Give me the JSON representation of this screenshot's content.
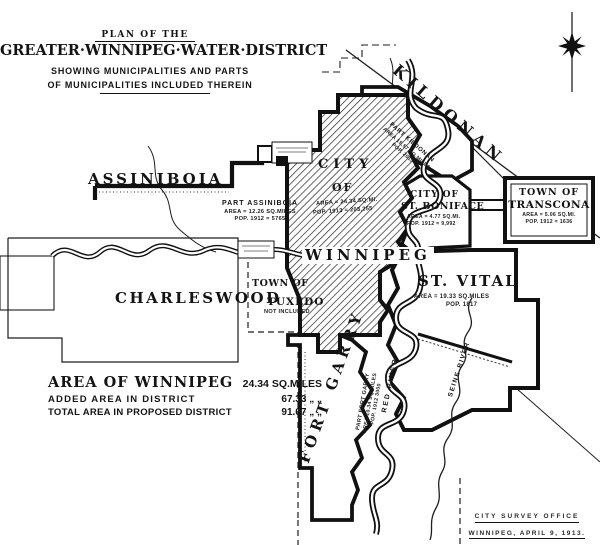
{
  "colors": {
    "ink": "#161616",
    "paper": "#ffffff"
  },
  "title": {
    "kicker": "PLAN OF THE",
    "main": "GREATER·WINNIPEG·WATER·DISTRICT",
    "sub1": "SHOWING MUNICIPALITIES AND PARTS",
    "sub2": "OF MUNICIPALITIES INCLUDED THEREIN"
  },
  "regions": {
    "assiniboia": {
      "name": "ASSINIBOIA",
      "part": "PART ASSINIBOIA",
      "area": "AREA = 12.26 SQ.MILES",
      "pop": "POP. 1912 = 5765"
    },
    "charleswood": {
      "name": "CHARLESWOOD"
    },
    "kildonan": {
      "name": "KILDONAN",
      "part": "PART KILDONAN",
      "area": "AREA 15.57 SQ.MILES",
      "pop": "POP. 2015"
    },
    "winnipeg": {
      "line1": "CITY",
      "line2": "OF",
      "line3": "WINNIPEG",
      "area": "AREA = 24.34 SQ.MI.",
      "pop": "POP. 1913 = 203,255"
    },
    "st_boniface": {
      "line1": "CITY OF",
      "line2": "ST. BONIFACE",
      "area": "AREA = 4.77 SQ.MI.",
      "pop": "POP. 1912 = 9,992"
    },
    "transcona": {
      "line1": "TOWN OF",
      "line2": "TRANSCONA",
      "area": "AREA = 5.06 SQ.MI.",
      "pop": "POP. 1912 = 1636"
    },
    "st_vital": {
      "name": "ST. VITAL",
      "area": "AREA = 19.33 SQ.MILES",
      "pop": "POP. 1817"
    },
    "tuxedo": {
      "line1": "TOWN OF",
      "line2": "TUXEDO",
      "note": "NOT INCLUDED"
    },
    "fort_garry": {
      "name": "FORT GARRY",
      "part": "PART FORT GARRY",
      "area": "AREA 10.34 SQ.MILES",
      "pop": "POP. 1912 3000"
    }
  },
  "rivers": {
    "red": "RED RIVER",
    "seine": "SEINE RIVER"
  },
  "legend": {
    "rows": [
      {
        "label": "AREA OF WINNIPEG",
        "value": "24.34 SQ.MILES"
      },
      {
        "label": "ADDED AREA IN DISTRICT",
        "value": "67.33 „   „"
      },
      {
        "label": "TOTAL AREA IN PROPOSED DISTRICT",
        "value": "91.67 „   „"
      }
    ]
  },
  "credit": {
    "line1": "CITY SURVEY OFFICE",
    "line2": "WINNIPEG, APRIL 9, 1913."
  }
}
